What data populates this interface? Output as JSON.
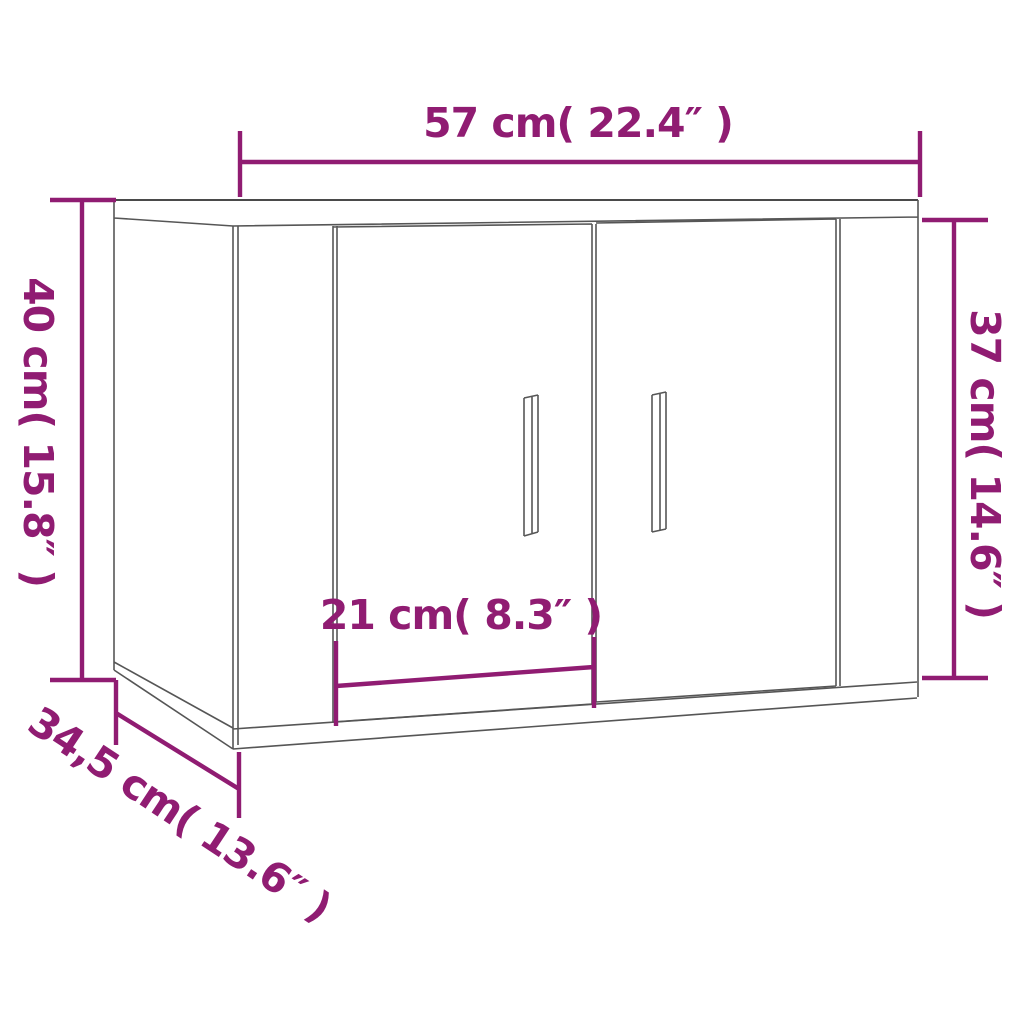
{
  "page": {
    "background_color": "#ffffff"
  },
  "diagram": {
    "subject": "wall-mounted two-door cabinet, three-quarter perspective line drawing",
    "accent_color": "#901C72",
    "outline_color": "#565656",
    "dimensions": {
      "width": {
        "label": "57 cm( 22.4″ )",
        "cm": 57,
        "inches": 22.4
      },
      "left_height": {
        "label": "40 cm( 15.8″ )",
        "cm": 40,
        "inches": 15.8
      },
      "right_height": {
        "label": "37 cm( 14.6″ )",
        "cm": 37,
        "inches": 14.6
      },
      "door_width": {
        "label": "21 cm( 8.3″ )",
        "cm": 21,
        "inches": 8.3
      },
      "depth": {
        "label": "34,5 cm( 13.6″ )",
        "cm": 34.5,
        "inches": 13.6
      }
    }
  }
}
